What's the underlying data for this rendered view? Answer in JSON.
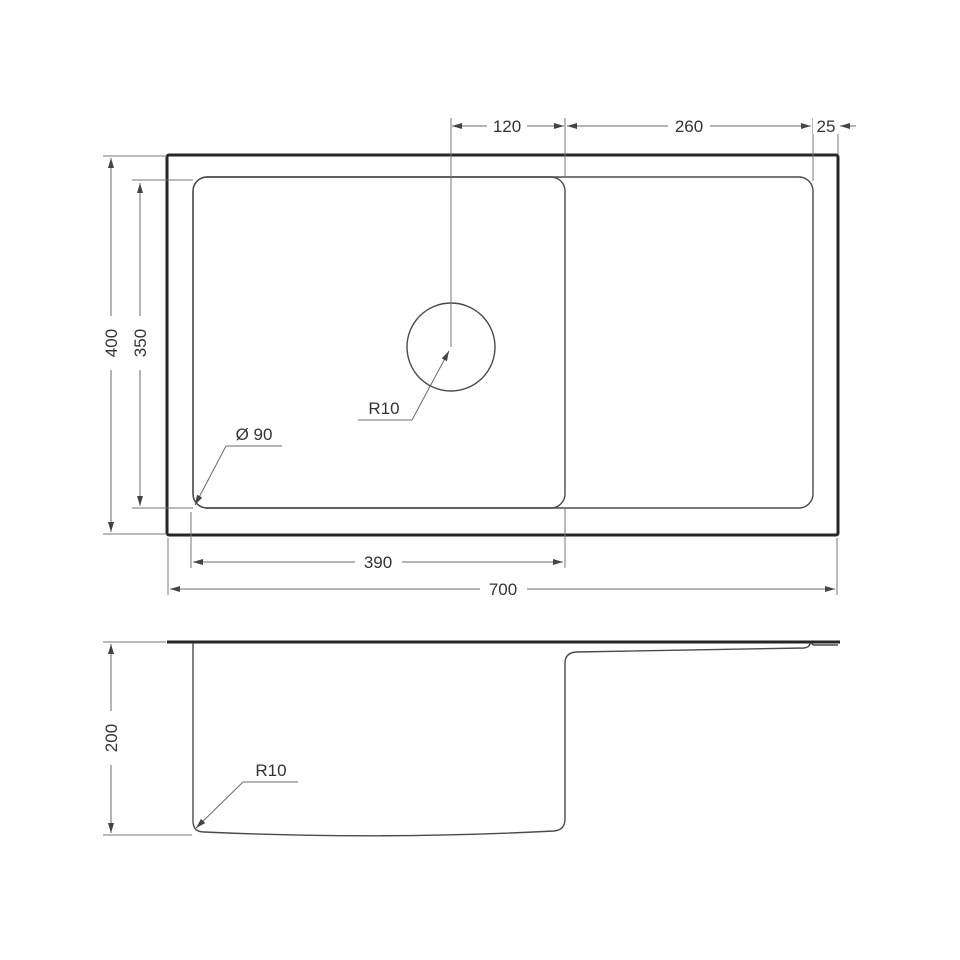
{
  "drawing": {
    "type": "technical-dimension-drawing",
    "subject": "undermount-sink-with-drainboard",
    "views": [
      "top-view",
      "side-section-view"
    ]
  },
  "dimensions": {
    "hole_center_to_divider": "120",
    "divider_to_inner_right": "260",
    "rim_width": "25",
    "overall_depth": "400",
    "inner_depth": "350",
    "bowl_width": "390",
    "overall_width": "700",
    "bowl_depth_side": "200",
    "drain_diameter_label": "Ø 90",
    "corner_radius_top_label": "R10",
    "corner_radius_side_label": "R10"
  },
  "colors": {
    "background": "#ffffff",
    "object_line_thick": "#262626",
    "object_line_thin": "#4a4a4a",
    "dimension_line": "#6b6b6b",
    "text": "#333333"
  }
}
